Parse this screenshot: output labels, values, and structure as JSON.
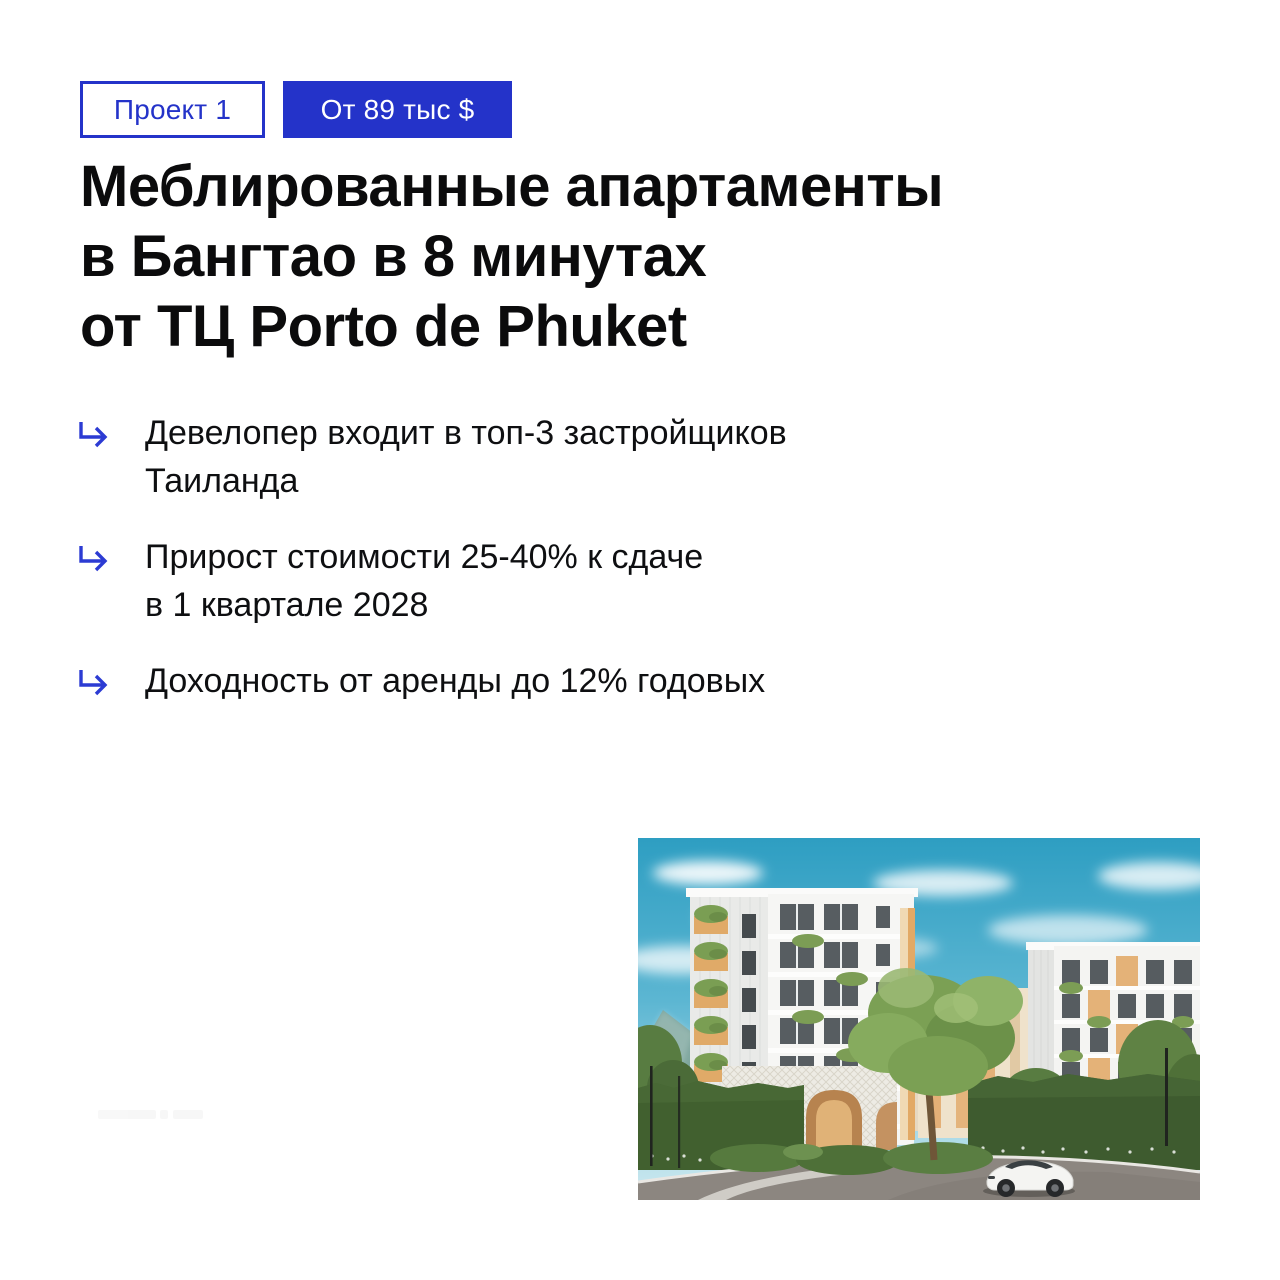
{
  "colors": {
    "accent_blue": "#2433c9",
    "heading_black": "#0b0b0c",
    "photo_sky": "#2e9ec2",
    "photo_hedge": "#3f5c31"
  },
  "badges": [
    {
      "label": "Проект 1",
      "style": "outline"
    },
    {
      "label": "От 89 тыс $",
      "style": "filled"
    }
  ],
  "title": {
    "lines": [
      "Меблированные апартаменты",
      "в Бангтао в 8 минутах",
      "от ТЦ Porto de Phuket"
    ]
  },
  "bullets": [
    {
      "icon": "return-arrow-icon",
      "text": "Девелопер входит в топ-3 застройщиков\nТаиланда"
    },
    {
      "icon": "return-arrow-icon",
      "text": "Прирост стоимости 25-40% к сдаче\nв 1 квартале 2028"
    },
    {
      "icon": "return-arrow-icon",
      "text": "Доходность от аренды до 12% годовых"
    }
  ],
  "photo": {
    "alt": "Render of a white low-rise apartment complex with plant-covered balconies, arched lattice entrance, green hedges, driveway and a white sports car under a blue sky"
  }
}
